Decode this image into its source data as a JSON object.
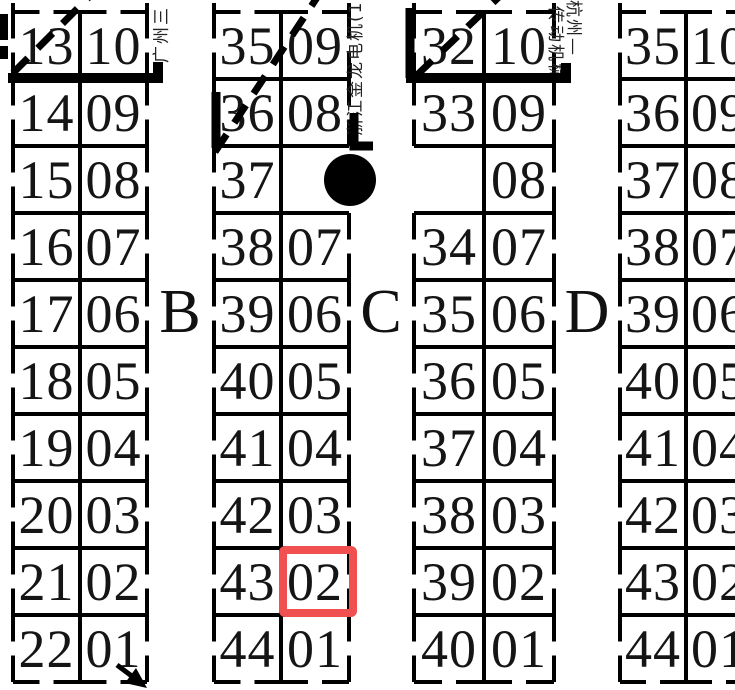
{
  "floor_plan": {
    "section_labels": [
      "B",
      "C",
      "D"
    ],
    "vendor_labels": [
      "广州三",
      "浙江金龙电机(14",
      "杭州—",
      "传动机械"
    ],
    "highlighted_booth": {
      "group": "group-2",
      "row": 9,
      "value": "02",
      "color": "#f05050"
    },
    "markers": {
      "circle_marker": "filled black circle in group-2 empty cell (row 3)",
      "diagonal_marks": "dashed diagonal strokes across top corner cells",
      "arrow": "down-right arrow at bottom of group-1"
    },
    "groups": [
      {
        "name": "group-1",
        "rows": [
          [
            "13",
            "10"
          ],
          [
            "14",
            "09"
          ],
          [
            "15",
            "08"
          ],
          [
            "16",
            "07"
          ],
          [
            "17",
            "06"
          ],
          [
            "18",
            "05"
          ],
          [
            "19",
            "04"
          ],
          [
            "20",
            "03"
          ],
          [
            "21",
            "02"
          ],
          [
            "22",
            "01"
          ]
        ]
      },
      {
        "name": "group-2",
        "rows": [
          [
            "35",
            "09"
          ],
          [
            "36",
            "08"
          ],
          [
            "37",
            ""
          ],
          [
            "38",
            "07"
          ],
          [
            "39",
            "06"
          ],
          [
            "40",
            "05"
          ],
          [
            "41",
            "04"
          ],
          [
            "42",
            "03"
          ],
          [
            "43",
            "02"
          ],
          [
            "44",
            "01"
          ]
        ]
      },
      {
        "name": "group-3",
        "rows": [
          [
            "32",
            "10"
          ],
          [
            "33",
            "09"
          ],
          [
            "",
            "08"
          ],
          [
            "34",
            "07"
          ],
          [
            "35",
            "06"
          ],
          [
            "36",
            "05"
          ],
          [
            "37",
            "04"
          ],
          [
            "38",
            "03"
          ],
          [
            "39",
            "02"
          ],
          [
            "40",
            "01"
          ]
        ]
      },
      {
        "name": "group-4",
        "rows": [
          [
            "35",
            "10"
          ],
          [
            "36",
            "09"
          ],
          [
            "37",
            "08"
          ],
          [
            "38",
            "07"
          ],
          [
            "39",
            "06"
          ],
          [
            "40",
            "05"
          ],
          [
            "41",
            "04"
          ],
          [
            "42",
            "03"
          ],
          [
            "43",
            "02"
          ],
          [
            "44",
            "01"
          ]
        ]
      }
    ]
  }
}
